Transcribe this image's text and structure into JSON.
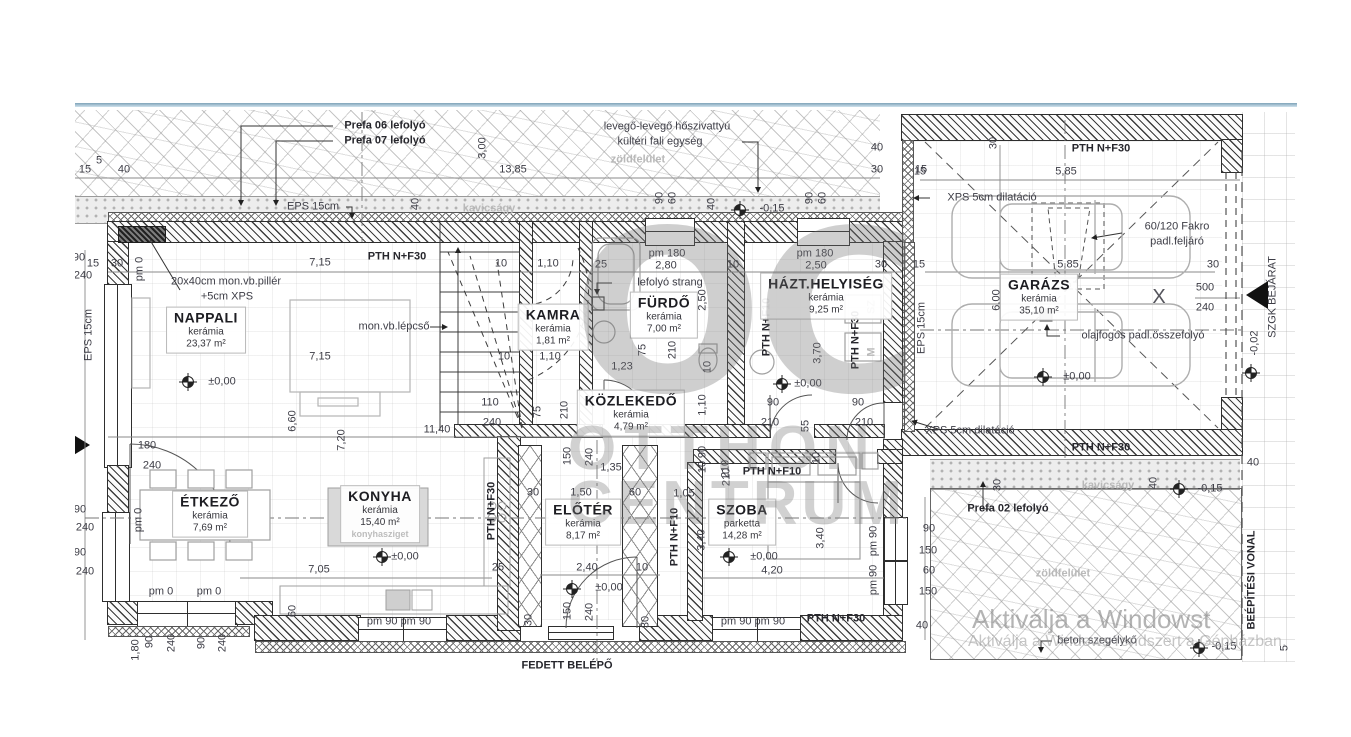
{
  "drawing": {
    "watermark_logo": "OC",
    "watermark_line1": "OTTHON",
    "watermark_line2": "CENTRUM",
    "activation_line1": "Aktiválja a Windowst",
    "activation_line2": "Aktiválja a Windows rendszert a Gépházban."
  },
  "rooms": [
    {
      "id": "nappali",
      "name": "NAPPALI",
      "finish": "kerámia",
      "area": "23,37 m²",
      "x": 206,
      "y": 330
    },
    {
      "id": "etkezo",
      "name": "ÉTKEZŐ",
      "finish": "kerámia",
      "area": "7,69 m²",
      "x": 210,
      "y": 514
    },
    {
      "id": "konyha",
      "name": "KONYHA",
      "finish": "kerámia",
      "area": "15,40 m²",
      "extra": "konyhasziget",
      "x": 380,
      "y": 514
    },
    {
      "id": "kamra",
      "name": "KAMRA",
      "finish": "kerámia",
      "area": "1,81 m²",
      "x": 553,
      "y": 327
    },
    {
      "id": "furdo",
      "name": "FÜRDŐ",
      "finish": "kerámia",
      "area": "7,00 m²",
      "x": 664,
      "y": 315
    },
    {
      "id": "kozlekedo",
      "name": "KÖZLEKEDŐ",
      "finish": "kerámia",
      "area": "4,79 m²",
      "x": 631,
      "y": 413
    },
    {
      "id": "hazt-helyiseg",
      "name": "HÁZT.HELYISÉG",
      "finish": "kerámia",
      "area": "9,25 m²",
      "x": 826,
      "y": 296
    },
    {
      "id": "eloter",
      "name": "ELŐTÉR",
      "finish": "kerámia",
      "area": "8,17 m²",
      "x": 583,
      "y": 522
    },
    {
      "id": "szoba",
      "name": "SZOBA",
      "finish": "parketta",
      "area": "14,28 m²",
      "x": 742,
      "y": 522
    },
    {
      "id": "garazs",
      "name": "GARÁZS",
      "finish": "kerámia",
      "area": "35,10 m²",
      "x": 1039,
      "y": 297
    }
  ],
  "labels": [
    {
      "t": "Prefa 06 lefolyó",
      "x": 385,
      "y": 126,
      "c": "b"
    },
    {
      "t": "Prefa 07 lefolyó",
      "x": 385,
      "y": 141,
      "c": "b"
    },
    {
      "t": "levegő-levegő hőszivattyú",
      "x": 667,
      "y": 127
    },
    {
      "t": "kültéri fali egység",
      "x": 660,
      "y": 142
    },
    {
      "t": "zöldfelület",
      "x": 638,
      "y": 160,
      "c": "g"
    },
    {
      "t": "3,00",
      "x": 483,
      "y": 148,
      "r": 1
    },
    {
      "t": "15",
      "x": 85,
      "y": 170
    },
    {
      "t": "5",
      "x": 99,
      "y": 161
    },
    {
      "t": "40",
      "x": 124,
      "y": 170
    },
    {
      "t": "13,85",
      "x": 513,
      "y": 170
    },
    {
      "t": "40",
      "x": 877,
      "y": 148
    },
    {
      "t": "30",
      "x": 877,
      "y": 170
    },
    {
      "t": "15",
      "x": 921,
      "y": 170
    },
    {
      "t": "EPS 15cm",
      "x": 313,
      "y": 207
    },
    {
      "t": "kavicságy",
      "x": 489,
      "y": 209,
      "c": "g"
    },
    {
      "t": "40",
      "x": 416,
      "y": 204,
      "r": 1
    },
    {
      "t": "90",
      "x": 660,
      "y": 198,
      "r": 1
    },
    {
      "t": "60",
      "x": 673,
      "y": 198,
      "r": 1
    },
    {
      "t": "40",
      "x": 712,
      "y": 204,
      "r": 1
    },
    {
      "t": "-0,15",
      "x": 772,
      "y": 209
    },
    {
      "t": "90",
      "x": 810,
      "y": 198,
      "r": 1
    },
    {
      "t": "60",
      "x": 823,
      "y": 198,
      "r": 1
    },
    {
      "t": "15",
      "x": 93,
      "y": 264
    },
    {
      "t": "30",
      "x": 117,
      "y": 264
    },
    {
      "t": "90",
      "x": 79,
      "y": 258
    },
    {
      "t": "240",
      "x": 83,
      "y": 276
    },
    {
      "t": "pm 0",
      "x": 140,
      "y": 269,
      "r": 1
    },
    {
      "t": "7,15",
      "x": 320,
      "y": 263
    },
    {
      "t": "PTH N+F30",
      "x": 397,
      "y": 257,
      "c": "b"
    },
    {
      "t": "10",
      "x": 501,
      "y": 264
    },
    {
      "t": "1,10",
      "x": 548,
      "y": 264
    },
    {
      "t": "25",
      "x": 601,
      "y": 265
    },
    {
      "t": "pm 180",
      "x": 667,
      "y": 254
    },
    {
      "t": "2,80",
      "x": 666,
      "y": 266
    },
    {
      "t": "10",
      "x": 733,
      "y": 265
    },
    {
      "t": "pm 180",
      "x": 815,
      "y": 254
    },
    {
      "t": "2,50",
      "x": 816,
      "y": 266
    },
    {
      "t": "30",
      "x": 881,
      "y": 265
    },
    {
      "t": "20x40cm mon.vb.pillér",
      "x": 226,
      "y": 282
    },
    {
      "t": "+5cm XPS",
      "x": 227,
      "y": 297
    },
    {
      "t": "mon.vb.lépcső",
      "x": 394,
      "y": 327
    },
    {
      "t": "7,15",
      "x": 320,
      "y": 357
    },
    {
      "t": "±0,00",
      "x": 222,
      "y": 382
    },
    {
      "t": "EPS 15cm",
      "x": 89,
      "y": 335,
      "r": 1
    },
    {
      "t": "6,60",
      "x": 293,
      "y": 421,
      "r": 1
    },
    {
      "t": "7,20",
      "x": 342,
      "y": 440,
      "r": 1
    },
    {
      "t": "11,40",
      "x": 437,
      "y": 430
    },
    {
      "t": "180",
      "x": 147,
      "y": 446
    },
    {
      "t": "240",
      "x": 152,
      "y": 466
    },
    {
      "t": "110",
      "x": 490,
      "y": 403
    },
    {
      "t": "240",
      "x": 492,
      "y": 423
    },
    {
      "t": "10",
      "x": 504,
      "y": 357
    },
    {
      "t": "1,10",
      "x": 550,
      "y": 357
    },
    {
      "t": "75",
      "x": 538,
      "y": 412,
      "r": 1
    },
    {
      "t": "210",
      "x": 565,
      "y": 410,
      "r": 1
    },
    {
      "t": "lefolyó strang",
      "x": 670,
      "y": 283
    },
    {
      "t": "2,50",
      "x": 703,
      "y": 300,
      "r": 1
    },
    {
      "t": "75",
      "x": 643,
      "y": 350,
      "r": 1
    },
    {
      "t": "210",
      "x": 673,
      "y": 350,
      "r": 1
    },
    {
      "t": "1,23",
      "x": 622,
      "y": 367
    },
    {
      "t": "10",
      "x": 708,
      "y": 367,
      "r": 1
    },
    {
      "t": "3,70",
      "x": 818,
      "y": 353,
      "r": 1
    },
    {
      "t": "PTH N+F10",
      "x": 767,
      "y": 327,
      "r": 1,
      "c": "b"
    },
    {
      "t": "PTH N+F30",
      "x": 856,
      "y": 340,
      "r": 1,
      "c": "b"
    },
    {
      "t": "SZ",
      "x": 872,
      "y": 307,
      "c": "g",
      "r": 1
    },
    {
      "t": "M",
      "x": 872,
      "y": 352,
      "c": "g",
      "r": 1
    },
    {
      "t": "±0,00",
      "x": 808,
      "y": 384
    },
    {
      "t": "EPS 15cm",
      "x": 922,
      "y": 328,
      "r": 1
    },
    {
      "t": "90",
      "x": 773,
      "y": 403
    },
    {
      "t": "210",
      "x": 770,
      "y": 423
    },
    {
      "t": "55",
      "x": 806,
      "y": 426,
      "r": 1
    },
    {
      "t": "90",
      "x": 858,
      "y": 403
    },
    {
      "t": "210",
      "x": 864,
      "y": 423
    },
    {
      "t": "10",
      "x": 817,
      "y": 458,
      "r": 1
    },
    {
      "t": "XPS 5cm dilatáció",
      "x": 970,
      "y": 431
    },
    {
      "t": "1,10",
      "x": 703,
      "y": 405,
      "r": 1
    },
    {
      "t": "150",
      "x": 568,
      "y": 456,
      "r": 1
    },
    {
      "t": "240",
      "x": 590,
      "y": 457,
      "r": 1
    },
    {
      "t": "1,35",
      "x": 611,
      "y": 468
    },
    {
      "t": "1,50",
      "x": 581,
      "y": 493
    },
    {
      "t": "60",
      "x": 635,
      "y": 493
    },
    {
      "t": "1,05",
      "x": 684,
      "y": 494
    },
    {
      "t": "90",
      "x": 703,
      "y": 452,
      "r": 1
    },
    {
      "t": "10",
      "x": 703,
      "y": 467,
      "r": 1
    },
    {
      "t": "210",
      "x": 727,
      "y": 477,
      "r": 1
    },
    {
      "t": "PTH N+F10",
      "x": 772,
      "y": 472,
      "c": "b"
    },
    {
      "t": "30",
      "x": 533,
      "y": 493
    },
    {
      "t": "25",
      "x": 498,
      "y": 568
    },
    {
      "t": "2,40",
      "x": 587,
      "y": 568
    },
    {
      "t": "10",
      "x": 642,
      "y": 568
    },
    {
      "t": "±0,00",
      "x": 609,
      "y": 588
    },
    {
      "t": "150",
      "x": 568,
      "y": 611,
      "r": 1
    },
    {
      "t": "240",
      "x": 590,
      "y": 612,
      "r": 1
    },
    {
      "t": "30",
      "x": 529,
      "y": 620,
      "r": 1
    },
    {
      "t": "30",
      "x": 646,
      "y": 622,
      "r": 1
    },
    {
      "t": "PTH N+F30",
      "x": 492,
      "y": 511,
      "r": 1,
      "c": "b"
    },
    {
      "t": "PTH N+F10",
      "x": 675,
      "y": 537,
      "r": 1,
      "c": "b"
    },
    {
      "t": "3,40",
      "x": 702,
      "y": 540,
      "r": 1
    },
    {
      "t": "±0,00",
      "x": 764,
      "y": 557
    },
    {
      "t": "4,20",
      "x": 772,
      "y": 571
    },
    {
      "t": "3,40",
      "x": 821,
      "y": 538,
      "r": 1
    },
    {
      "t": "pm 90",
      "x": 874,
      "y": 541,
      "r": 1
    },
    {
      "t": "pm 90",
      "x": 874,
      "y": 580,
      "r": 1
    },
    {
      "t": "pm 90 pm 90",
      "x": 753,
      "y": 622
    },
    {
      "t": "PTH N+F30",
      "x": 836,
      "y": 619,
      "c": "b"
    },
    {
      "t": "210",
      "x": 726,
      "y": 469,
      "r": 1
    },
    {
      "t": "90",
      "x": 929,
      "y": 529
    },
    {
      "t": "150",
      "x": 928,
      "y": 551
    },
    {
      "t": "60",
      "x": 929,
      "y": 571
    },
    {
      "t": "150",
      "x": 928,
      "y": 592
    },
    {
      "t": "40",
      "x": 922,
      "y": 626
    },
    {
      "t": "7,05",
      "x": 319,
      "y": 570
    },
    {
      "t": "pm 0",
      "x": 161,
      "y": 592
    },
    {
      "t": "pm 0",
      "x": 209,
      "y": 592
    },
    {
      "t": "90",
      "x": 150,
      "y": 642,
      "r": 1
    },
    {
      "t": "240",
      "x": 172,
      "y": 643,
      "r": 1
    },
    {
      "t": "90",
      "x": 202,
      "y": 643,
      "r": 1
    },
    {
      "t": "240",
      "x": 223,
      "y": 643,
      "r": 1
    },
    {
      "t": "1,80",
      "x": 136,
      "y": 650,
      "r": 1
    },
    {
      "t": "60",
      "x": 293,
      "y": 611,
      "r": 1
    },
    {
      "t": "pm 90 pm 90",
      "x": 399,
      "y": 622
    },
    {
      "t": "90",
      "x": 80,
      "y": 510
    },
    {
      "t": "240",
      "x": 85,
      "y": 528
    },
    {
      "t": "90",
      "x": 80,
      "y": 553
    },
    {
      "t": "240",
      "x": 85,
      "y": 572
    },
    {
      "t": "pm 0",
      "x": 139,
      "y": 520,
      "r": 1
    },
    {
      "t": "FEDETT BELÉPŐ",
      "x": 567,
      "y": 666,
      "c": "b"
    },
    {
      "t": "±0,00",
      "x": 405,
      "y": 557
    },
    {
      "t": "PTH N+F30",
      "x": 1101,
      "y": 149,
      "c": "b"
    },
    {
      "t": "5,85",
      "x": 1066,
      "y": 172
    },
    {
      "t": "30",
      "x": 994,
      "y": 143,
      "r": 1
    },
    {
      "t": "XPS 5cm dilatáció",
      "x": 992,
      "y": 198
    },
    {
      "t": "15",
      "x": 920,
      "y": 172
    },
    {
      "t": "60/120 Fakro",
      "x": 1177,
      "y": 227
    },
    {
      "t": "padl.feljáró",
      "x": 1177,
      "y": 242
    },
    {
      "t": "5,85",
      "x": 1068,
      "y": 265
    },
    {
      "t": "15",
      "x": 919,
      "y": 265
    },
    {
      "t": "30",
      "x": 1213,
      "y": 265
    },
    {
      "t": "6,00",
      "x": 997,
      "y": 300,
      "r": 1
    },
    {
      "t": "X",
      "x": 1159,
      "y": 297,
      "c": "big"
    },
    {
      "t": "500",
      "x": 1205,
      "y": 288
    },
    {
      "t": "240",
      "x": 1205,
      "y": 308
    },
    {
      "t": "olajfogós padl.összefolyó",
      "x": 1143,
      "y": 336
    },
    {
      "t": "±0,00",
      "x": 1077,
      "y": 377
    },
    {
      "t": "SZGK BEJÁRAT",
      "x": 1273,
      "y": 297,
      "r": 1
    },
    {
      "t": "-0,02",
      "x": 1255,
      "y": 343,
      "r": 1
    },
    {
      "t": "PTH N+F30",
      "x": 1101,
      "y": 448,
      "c": "b"
    },
    {
      "t": "kavicságy",
      "x": 1108,
      "y": 486,
      "c": "g"
    },
    {
      "t": "40",
      "x": 1154,
      "y": 483,
      "r": 1
    },
    {
      "t": "-0,15",
      "x": 1210,
      "y": 489
    },
    {
      "t": "40",
      "x": 1253,
      "y": 463
    },
    {
      "t": "30",
      "x": 998,
      "y": 485,
      "r": 1
    },
    {
      "t": "Prefa 02 lefolyó",
      "x": 1008,
      "y": 509,
      "c": "b"
    },
    {
      "t": "zöldfelület",
      "x": 1063,
      "y": 574,
      "c": "g"
    },
    {
      "t": "beton szegélykő",
      "x": 1097,
      "y": 641
    },
    {
      "t": "-0,15",
      "x": 1224,
      "y": 647
    },
    {
      "t": "BEÉPÍTÉSI VONAL",
      "x": 1252,
      "y": 580,
      "r": 1,
      "c": "b"
    },
    {
      "t": "5",
      "x": 1285,
      "y": 648,
      "r": 1
    }
  ]
}
